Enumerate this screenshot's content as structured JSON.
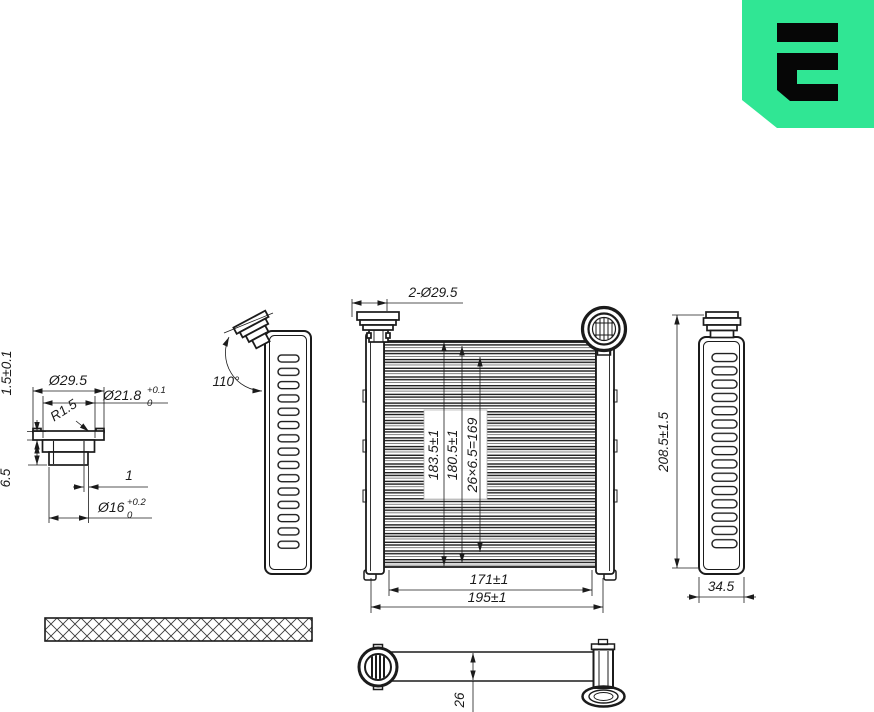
{
  "colors": {
    "logo_green": "#30E694",
    "ink": "#1b1b1b"
  },
  "logo": {
    "glyph": "stylized-E-mark"
  },
  "flange_detail": {
    "outer_diameter": "Ø29.5",
    "step_diameter": "Ø21.8",
    "step_tol_plus": "+0.1",
    "step_tol_minus": "0",
    "corner_radius": "R1.5",
    "lip_thickness": "1.5±0.1",
    "collar_height": "6.5",
    "wall_thickness": "1",
    "bore_diameter": "Ø16",
    "bore_tol_plus": "+0.2",
    "bore_tol_minus": "0"
  },
  "left_side_view": {
    "port_angle": "110°"
  },
  "front_view": {
    "ports_dim": "2-Ø29.5",
    "core_height": "183.5±1",
    "fin_pack_height": "180.5±1",
    "tube_pitch_calc": "26×6.5=169",
    "core_width": "171±1",
    "overall_width": "195±1"
  },
  "right_side_view": {
    "overall_height": "208.5±1.5",
    "depth": "34.5"
  },
  "bottom_view": {
    "core_thickness": "26"
  }
}
